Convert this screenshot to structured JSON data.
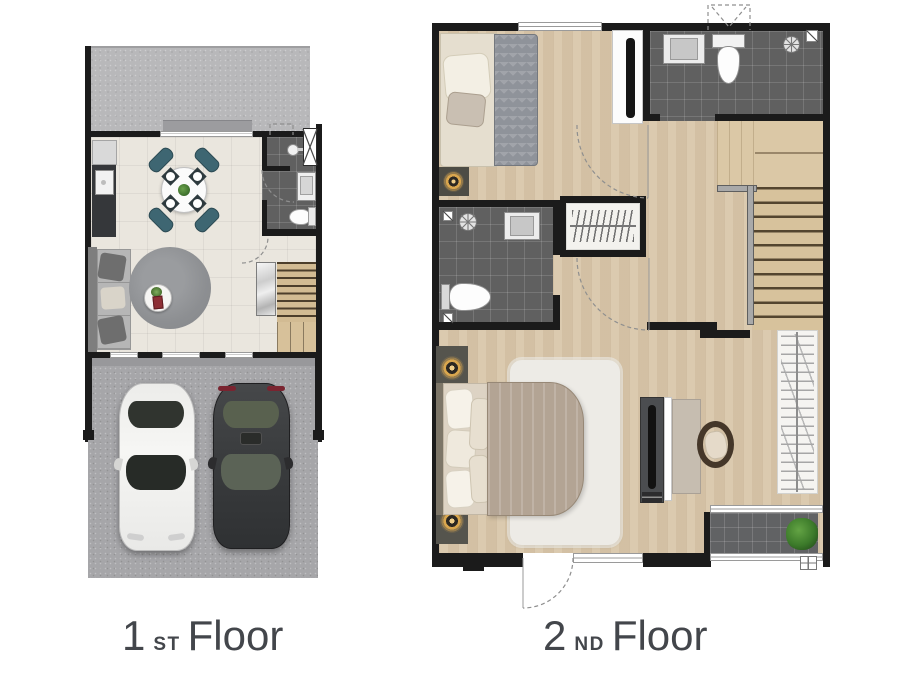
{
  "page": {
    "background": "#ffffff",
    "kind": "two-storey townhouse floor plan"
  },
  "labels": {
    "floor1": {
      "number": "1",
      "ordinal": "ST",
      "word": "Floor"
    },
    "floor2": {
      "number": "2",
      "ordinal": "ND",
      "word": "Floor"
    }
  },
  "palette": {
    "wall": "#1b1b1b",
    "tile_floor": "#eae6de",
    "wood_floor": "#d8c6a9",
    "bath_tile": "#606060",
    "yard_concrete": "#b8b8ba",
    "garage_concrete": "#a6a6a9",
    "chair_teal": "#3e6672",
    "sofa_gray": "#b6b6b6",
    "rug_gray": "#8f9194",
    "lamp_gold": "#d9a64e",
    "blanket_taupe": "#b3a494",
    "label_text": "#43464b",
    "plant_green": "#3f7d2f"
  },
  "floor1": {
    "rooms": [
      {
        "name": "front-yard",
        "furniture": [
          "entry-step",
          "ac-ledge-marker"
        ]
      },
      {
        "name": "living-dining-kitchen",
        "furniture": [
          "kitchen-counter",
          "refrigerator",
          "sink-counter",
          "dining-table",
          "dining-chairs-x4",
          "place-settings-x4",
          "sofa",
          "round-rug",
          "coffee-table",
          "staircase",
          "marble-panel"
        ]
      },
      {
        "name": "bathroom",
        "furniture": [
          "wall-sink",
          "basin-counter",
          "toilet",
          "service-shaft"
        ]
      },
      {
        "name": "garage",
        "furniture": [
          "white-car",
          "black-car"
        ]
      }
    ]
  },
  "floor2": {
    "rooms": [
      {
        "name": "bedroom-2",
        "furniture": [
          "single-bed",
          "zigzag-blanket",
          "floor-lamp",
          "tv-stand",
          "window"
        ]
      },
      {
        "name": "bathroom-2",
        "furniture": [
          "sink-counter",
          "toilet",
          "shower",
          "floor-drain",
          "skylight-marker"
        ]
      },
      {
        "name": "hallway",
        "furniture": [
          "door-swing-arcs"
        ]
      },
      {
        "name": "closet",
        "furniture": [
          "hanger-rail"
        ]
      },
      {
        "name": "staircase",
        "furniture": [
          "railing",
          "landing",
          "treads"
        ]
      },
      {
        "name": "bathroom-1",
        "furniture": [
          "shower",
          "sink-counter",
          "toilet",
          "floor-drains"
        ]
      },
      {
        "name": "master-bedroom",
        "furniture": [
          "double-bed",
          "pillows",
          "striped-blanket",
          "nightstand-lamps-x2",
          "shag-rug",
          "tv-cabinet",
          "desk",
          "chair",
          "wardrobe-hangers"
        ]
      },
      {
        "name": "balcony",
        "furniture": [
          "potted-plant",
          "sliding-door-frame",
          "drain-grate"
        ]
      }
    ]
  }
}
